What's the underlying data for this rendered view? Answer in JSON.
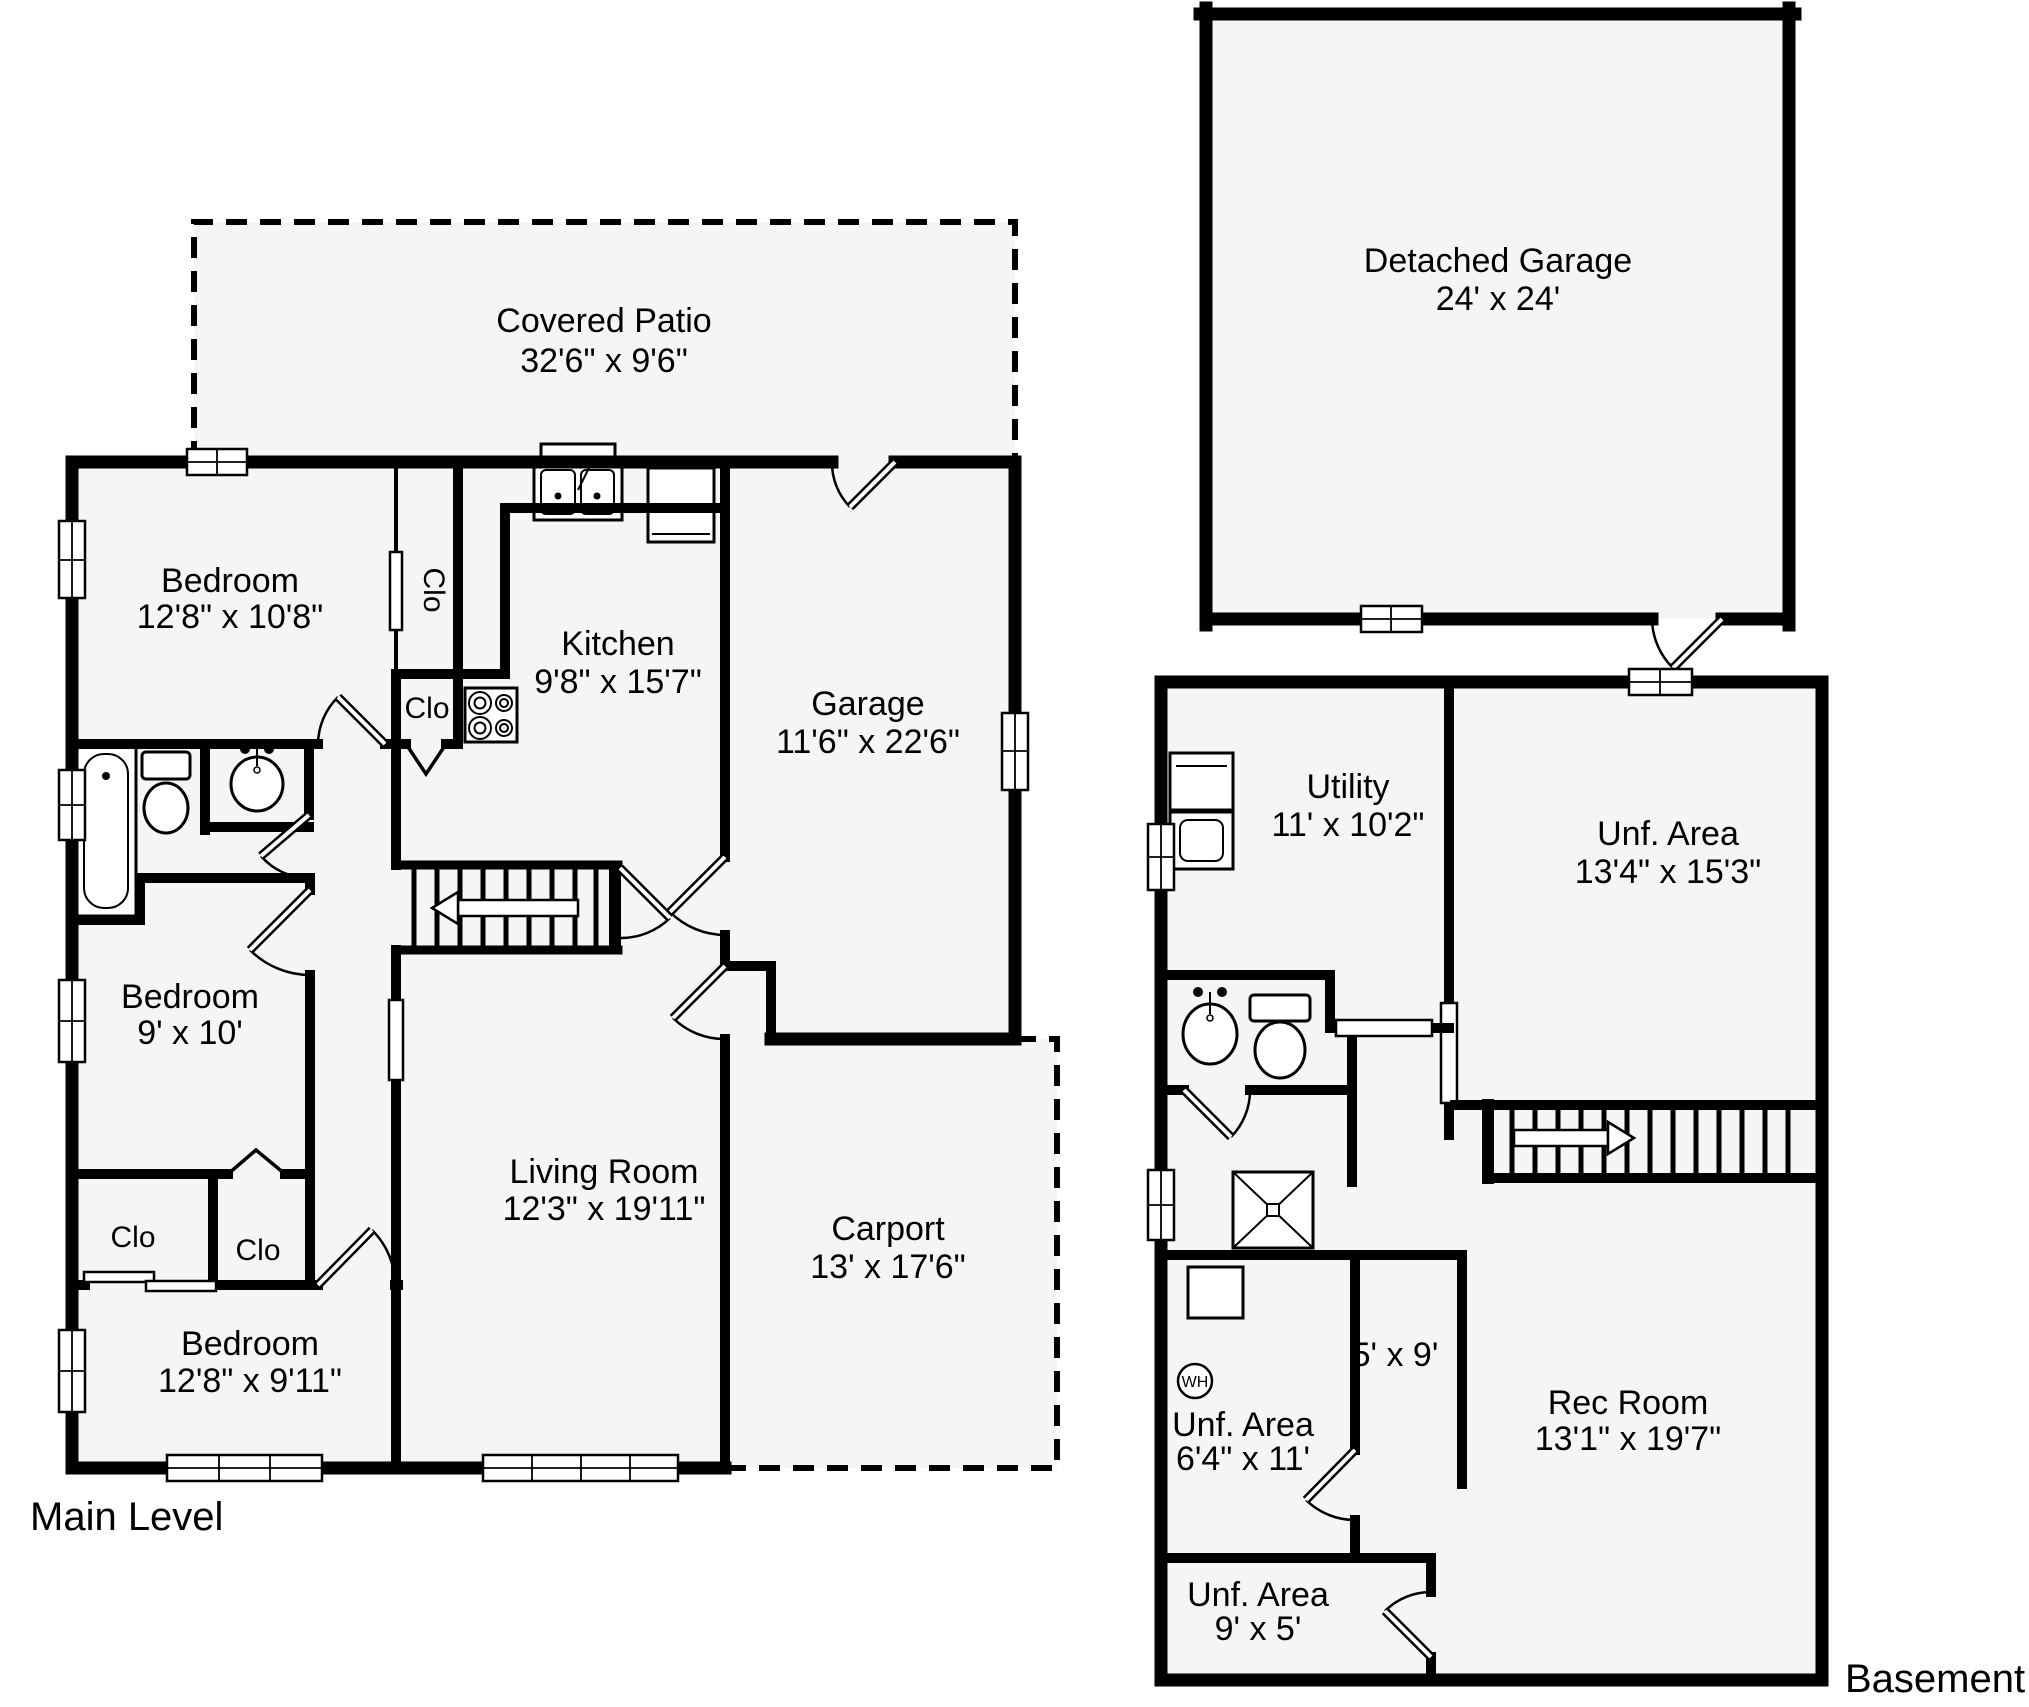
{
  "colors": {
    "wall": "#000000",
    "room_fill": "#f5f5f5",
    "background": "#ffffff",
    "text": "#000000"
  },
  "main_level": {
    "label": "Main Level",
    "rooms": {
      "covered_patio": {
        "name": "Covered Patio",
        "dims": "32'6\" x 9'6\""
      },
      "bedroom_top": {
        "name": "Bedroom",
        "dims": "12'8\" x 10'8\""
      },
      "closet_upper": {
        "label": "Clo"
      },
      "closet_mid": {
        "label": "Clo"
      },
      "kitchen": {
        "name": "Kitchen",
        "dims": "9'8\" x 15'7\""
      },
      "garage": {
        "name": "Garage",
        "dims": "11'6\" x 22'6\""
      },
      "bedroom_middle": {
        "name": "Bedroom",
        "dims": "9' x 10'"
      },
      "closet_left": {
        "label": "Clo"
      },
      "closet_right": {
        "label": "Clo"
      },
      "bedroom_bottom": {
        "name": "Bedroom",
        "dims": "12'8\" x 9'11\""
      },
      "living_room": {
        "name": "Living Room",
        "dims": "12'3\" x 19'11\""
      },
      "carport": {
        "name": "Carport",
        "dims": "13' x 17'6\""
      }
    }
  },
  "detached_garage": {
    "name": "Detached Garage",
    "dims": "24' x 24'"
  },
  "basement": {
    "label": "Basement",
    "rooms": {
      "utility": {
        "name": "Utility",
        "dims": "11' x 10'2\""
      },
      "unf_area_top": {
        "name": "Unf. Area",
        "dims": "13'4\" x 15'3\""
      },
      "small_room": {
        "dims": "5' x 9'"
      },
      "rec_room": {
        "name": "Rec Room",
        "dims": "13'1\" x 19'7\""
      },
      "unf_area_mid": {
        "name": "Unf. Area",
        "dims": "6'4\" x 11'"
      },
      "unf_area_bottom": {
        "name": "Unf. Area",
        "dims": "9' x 5'"
      },
      "water_heater": {
        "label": "WH"
      }
    }
  }
}
